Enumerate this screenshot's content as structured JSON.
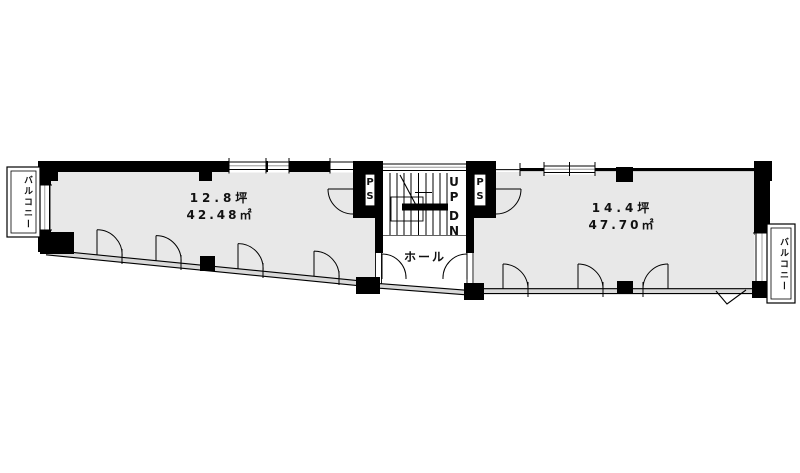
{
  "plan": {
    "left_room": {
      "size_tsubo": "12.8坪",
      "size_m2": "42.48㎡"
    },
    "right_room": {
      "size_tsubo": "14.4坪",
      "size_m2": "47.70㎡"
    },
    "hall_label": "ホール",
    "stairs": {
      "up_label": "UP",
      "down_label": "DN"
    },
    "pipe_shafts": {
      "left_label": "PS",
      "right_label": "PS"
    },
    "balconies": {
      "left_label": "バルコニー",
      "right_label": "バルコニー"
    },
    "colors": {
      "room_fill": "#e8e8e8",
      "wall": "#000000",
      "background": "#ffffff",
      "window_line": "#888888"
    }
  }
}
